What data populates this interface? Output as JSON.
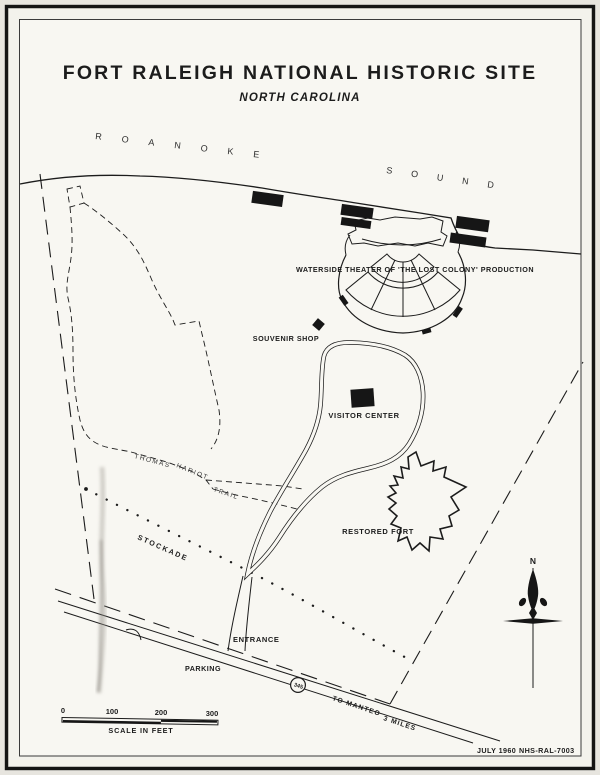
{
  "map": {
    "title": "FORT RALEIGH NATIONAL HISTORIC SITE",
    "subtitle": "NORTH CAROLINA",
    "water": {
      "roanoke": "ROANOKE",
      "sound": "SOUND"
    },
    "features": {
      "theater": "WATERSIDE THEATER OF 'THE LOST COLONY' PRODUCTION",
      "souvenir_shop": "SOUVENIR SHOP",
      "visitor_center": "VISITOR CENTER",
      "restored_fort": "RESTORED FORT",
      "trail_word_1": "THOMAS",
      "trail_word_2": "HARIOT",
      "trail_word_3": "TRAIL",
      "stockade": "STOCKADE",
      "entrance": "ENTRANCE",
      "parking": "PARKING"
    },
    "highway": {
      "route_shield": "345",
      "destination": "TO MANTEO",
      "distance": "3 MILES"
    },
    "compass": {
      "north_label": "N"
    },
    "scale_bar": {
      "tick_0": "0",
      "tick_100": "100",
      "tick_200": "200",
      "tick_300": "300",
      "caption": "SCALE IN FEET"
    },
    "footer": {
      "date": "JULY 1960",
      "drawing_id": "NHS-RAL-7003"
    },
    "colors": {
      "ink": "#1c1c1c",
      "paper": "#f8f7f2",
      "page": "#e7e5df"
    }
  }
}
